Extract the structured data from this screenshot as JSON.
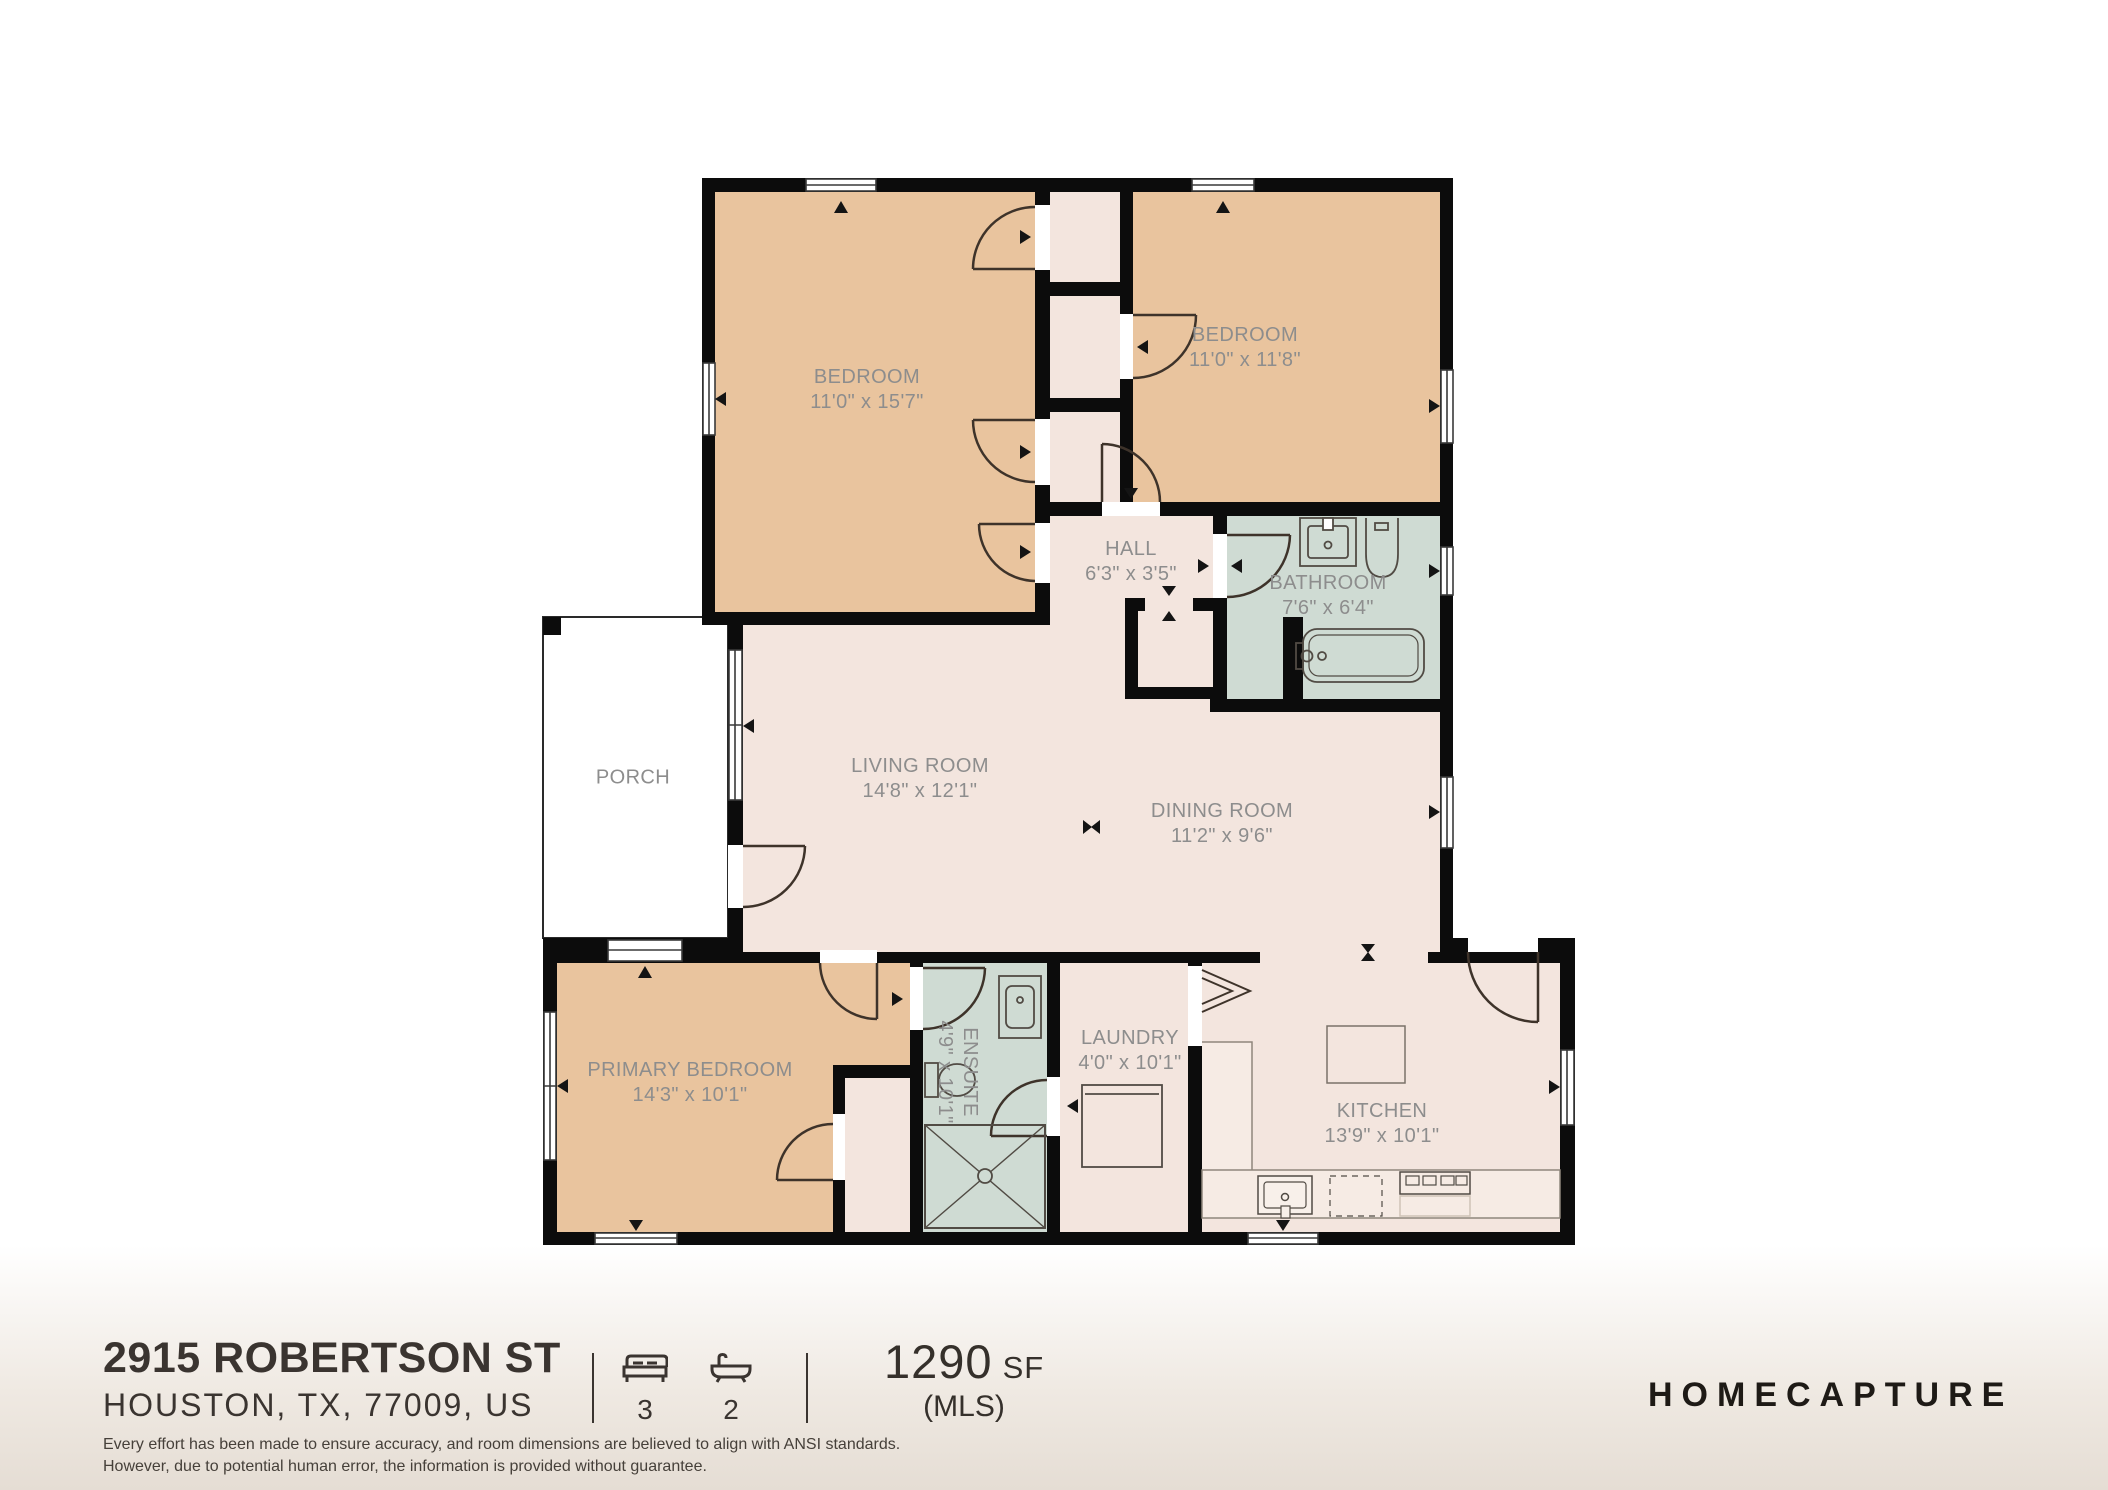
{
  "plan": {
    "rooms": [
      {
        "id": "bedroom-1",
        "name": "BEDROOM",
        "dims": "11'0\" x 15'7\""
      },
      {
        "id": "bedroom-2",
        "name": "BEDROOM",
        "dims": "11'0\" x 11'8\""
      },
      {
        "id": "hall",
        "name": "HALL",
        "dims": "6'3\" x 3'5\""
      },
      {
        "id": "bathroom",
        "name": "BATHROOM",
        "dims": "7'6\" x 6'4\""
      },
      {
        "id": "porch",
        "name": "PORCH",
        "dims": ""
      },
      {
        "id": "living-room",
        "name": "LIVING ROOM",
        "dims": "14'8\" x 12'1\""
      },
      {
        "id": "dining-room",
        "name": "DINING ROOM",
        "dims": "11'2\" x 9'6\""
      },
      {
        "id": "primary-bedroom",
        "name": "PRIMARY BEDROOM",
        "dims": "14'3\" x 10'1\""
      },
      {
        "id": "ensuite",
        "name": "ENSUITE",
        "dims": "4'9\" x 10'1\""
      },
      {
        "id": "laundry",
        "name": "LAUNDRY",
        "dims": "4'0\" x 10'1\""
      },
      {
        "id": "kitchen",
        "name": "KITCHEN",
        "dims": "13'9\" x 10'1\""
      }
    ],
    "colors": {
      "wall": "#0c0c0c",
      "bedroom_fill": "#e9c49e",
      "common_fill": "#f3e5de",
      "wet_room_fill": "#cfdbd3",
      "porch_fill": "#ffffff",
      "label_text": "#8d8d8d",
      "door_arc": "#3e332a"
    }
  },
  "footer": {
    "address_line1": "2915 ROBERTSON ST",
    "address_line2": "HOUSTON, TX, 77009, US",
    "beds": "3",
    "baths": "2",
    "area_value": "1290",
    "area_unit": "SF",
    "area_source": "(MLS)",
    "brand": "HOMECAPTURE",
    "disclaimer_line1": "Every effort has been made to ensure accuracy, and room dimensions are believed to align with ANSI standards.",
    "disclaimer_line2": "However, due to potential human error, the information is provided without guarantee."
  }
}
